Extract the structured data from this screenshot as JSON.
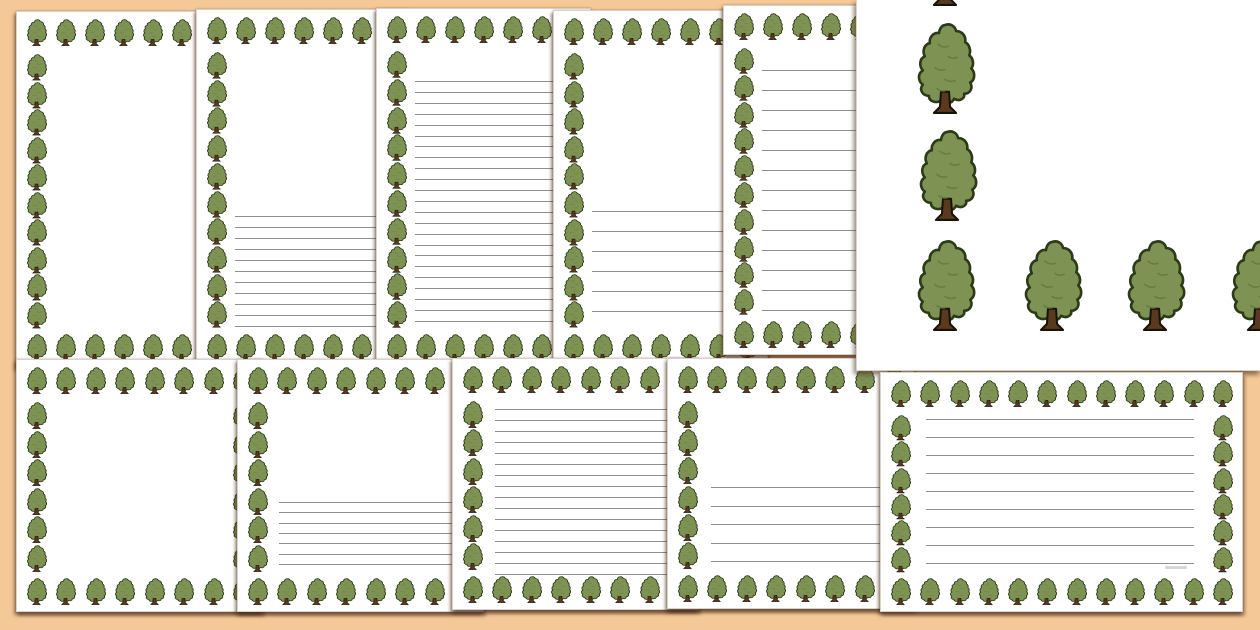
{
  "document_preview": {
    "theme": "tree-page-borders",
    "description_visible_text": "",
    "canvas": {
      "width": 1260,
      "height": 630,
      "background": "#f4c897"
    },
    "palette": {
      "page": "#ffffff",
      "page_edge": "#d8d2c8",
      "writing_line": "#8f8f8f",
      "tree_canopy": "#7e9254",
      "tree_outline": "#2c3a18",
      "tree_texture": "#66793f",
      "trunk": "#5a3a1e",
      "trunk_outline": "#19120a"
    },
    "small_tree": {
      "width": 21,
      "height": 28,
      "row_pitch": 30,
      "col_pitch": 29
    },
    "pages": [
      {
        "id": "top-1",
        "orientation": "portrait",
        "style": "blank",
        "x": 16,
        "y": 11,
        "w": 215,
        "h": 357,
        "z": 1,
        "lines": null
      },
      {
        "id": "top-2",
        "orientation": "portrait",
        "style": "half-lined-narrow",
        "x": 196,
        "y": 9,
        "w": 215,
        "h": 359,
        "z": 2,
        "lines": {
          "top": 206,
          "left": 38,
          "right": 18,
          "count": 11,
          "spacing": 11
        }
      },
      {
        "id": "top-3",
        "orientation": "portrait",
        "style": "fully-lined-narrow",
        "x": 376,
        "y": 8,
        "w": 215,
        "h": 360,
        "z": 3,
        "lines": {
          "top": 72,
          "left": 38,
          "right": 18,
          "count": 23,
          "spacing": 10.9
        }
      },
      {
        "id": "top-4",
        "orientation": "portrait",
        "style": "half-lined-wide",
        "x": 553,
        "y": 10,
        "w": 215,
        "h": 358,
        "z": 4,
        "lines": {
          "top": 200,
          "left": 38,
          "right": 18,
          "count": 6,
          "spacing": 20
        }
      },
      {
        "id": "top-5",
        "orientation": "portrait",
        "style": "fully-lined-wide",
        "x": 723,
        "y": 5,
        "w": 215,
        "h": 350,
        "z": 5,
        "lines": {
          "top": 64,
          "left": 38,
          "right": 18,
          "count": 13,
          "spacing": 20
        }
      },
      {
        "id": "bottom-1",
        "orientation": "landscape",
        "style": "blank",
        "x": 16,
        "y": 359,
        "w": 247,
        "h": 253,
        "z": 6,
        "lines": null
      },
      {
        "id": "bottom-2",
        "orientation": "landscape",
        "style": "half-lined-narrow",
        "x": 237,
        "y": 359,
        "w": 247,
        "h": 253,
        "z": 7,
        "lines": {
          "top": 142,
          "left": 41,
          "right": 20,
          "count": 7,
          "spacing": 10.3
        }
      },
      {
        "id": "bottom-3",
        "orientation": "landscape",
        "style": "fully-lined-narrow",
        "x": 452,
        "y": 358,
        "w": 247,
        "h": 252,
        "z": 8,
        "lines": {
          "top": 50,
          "left": 42,
          "right": 20,
          "count": 16,
          "spacing": 11
        }
      },
      {
        "id": "bottom-4",
        "orientation": "landscape",
        "style": "half-lined-wide",
        "x": 667,
        "y": 358,
        "w": 247,
        "h": 251,
        "z": 9,
        "lines": {
          "top": 128,
          "left": 43,
          "right": 20,
          "count": 5,
          "spacing": 18.5
        }
      },
      {
        "id": "bottom-5",
        "orientation": "landscape",
        "style": "fully-lined-wide",
        "x": 880,
        "y": 372,
        "w": 363,
        "h": 240,
        "z": 11,
        "lines": {
          "top": 46,
          "left": 45,
          "right": 48,
          "count": 9,
          "spacing": 18
        },
        "watermark": {
          "right": 55,
          "top": 193,
          "w": 22,
          "h": 3
        }
      }
    ],
    "detail_panel": {
      "id": "border-closeup",
      "x": 856,
      "y": 0,
      "w": 404,
      "h": 371,
      "z": 10,
      "tree_size": {
        "w": 62,
        "h": 96
      },
      "trees": [
        {
          "x": 57,
          "y": -86
        },
        {
          "x": 57,
          "y": 22
        },
        {
          "x": 59,
          "y": 129
        },
        {
          "x": 57,
          "y": 239
        },
        {
          "x": 164,
          "y": 239
        },
        {
          "x": 267,
          "y": 239
        },
        {
          "x": 371,
          "y": 239
        }
      ]
    }
  }
}
